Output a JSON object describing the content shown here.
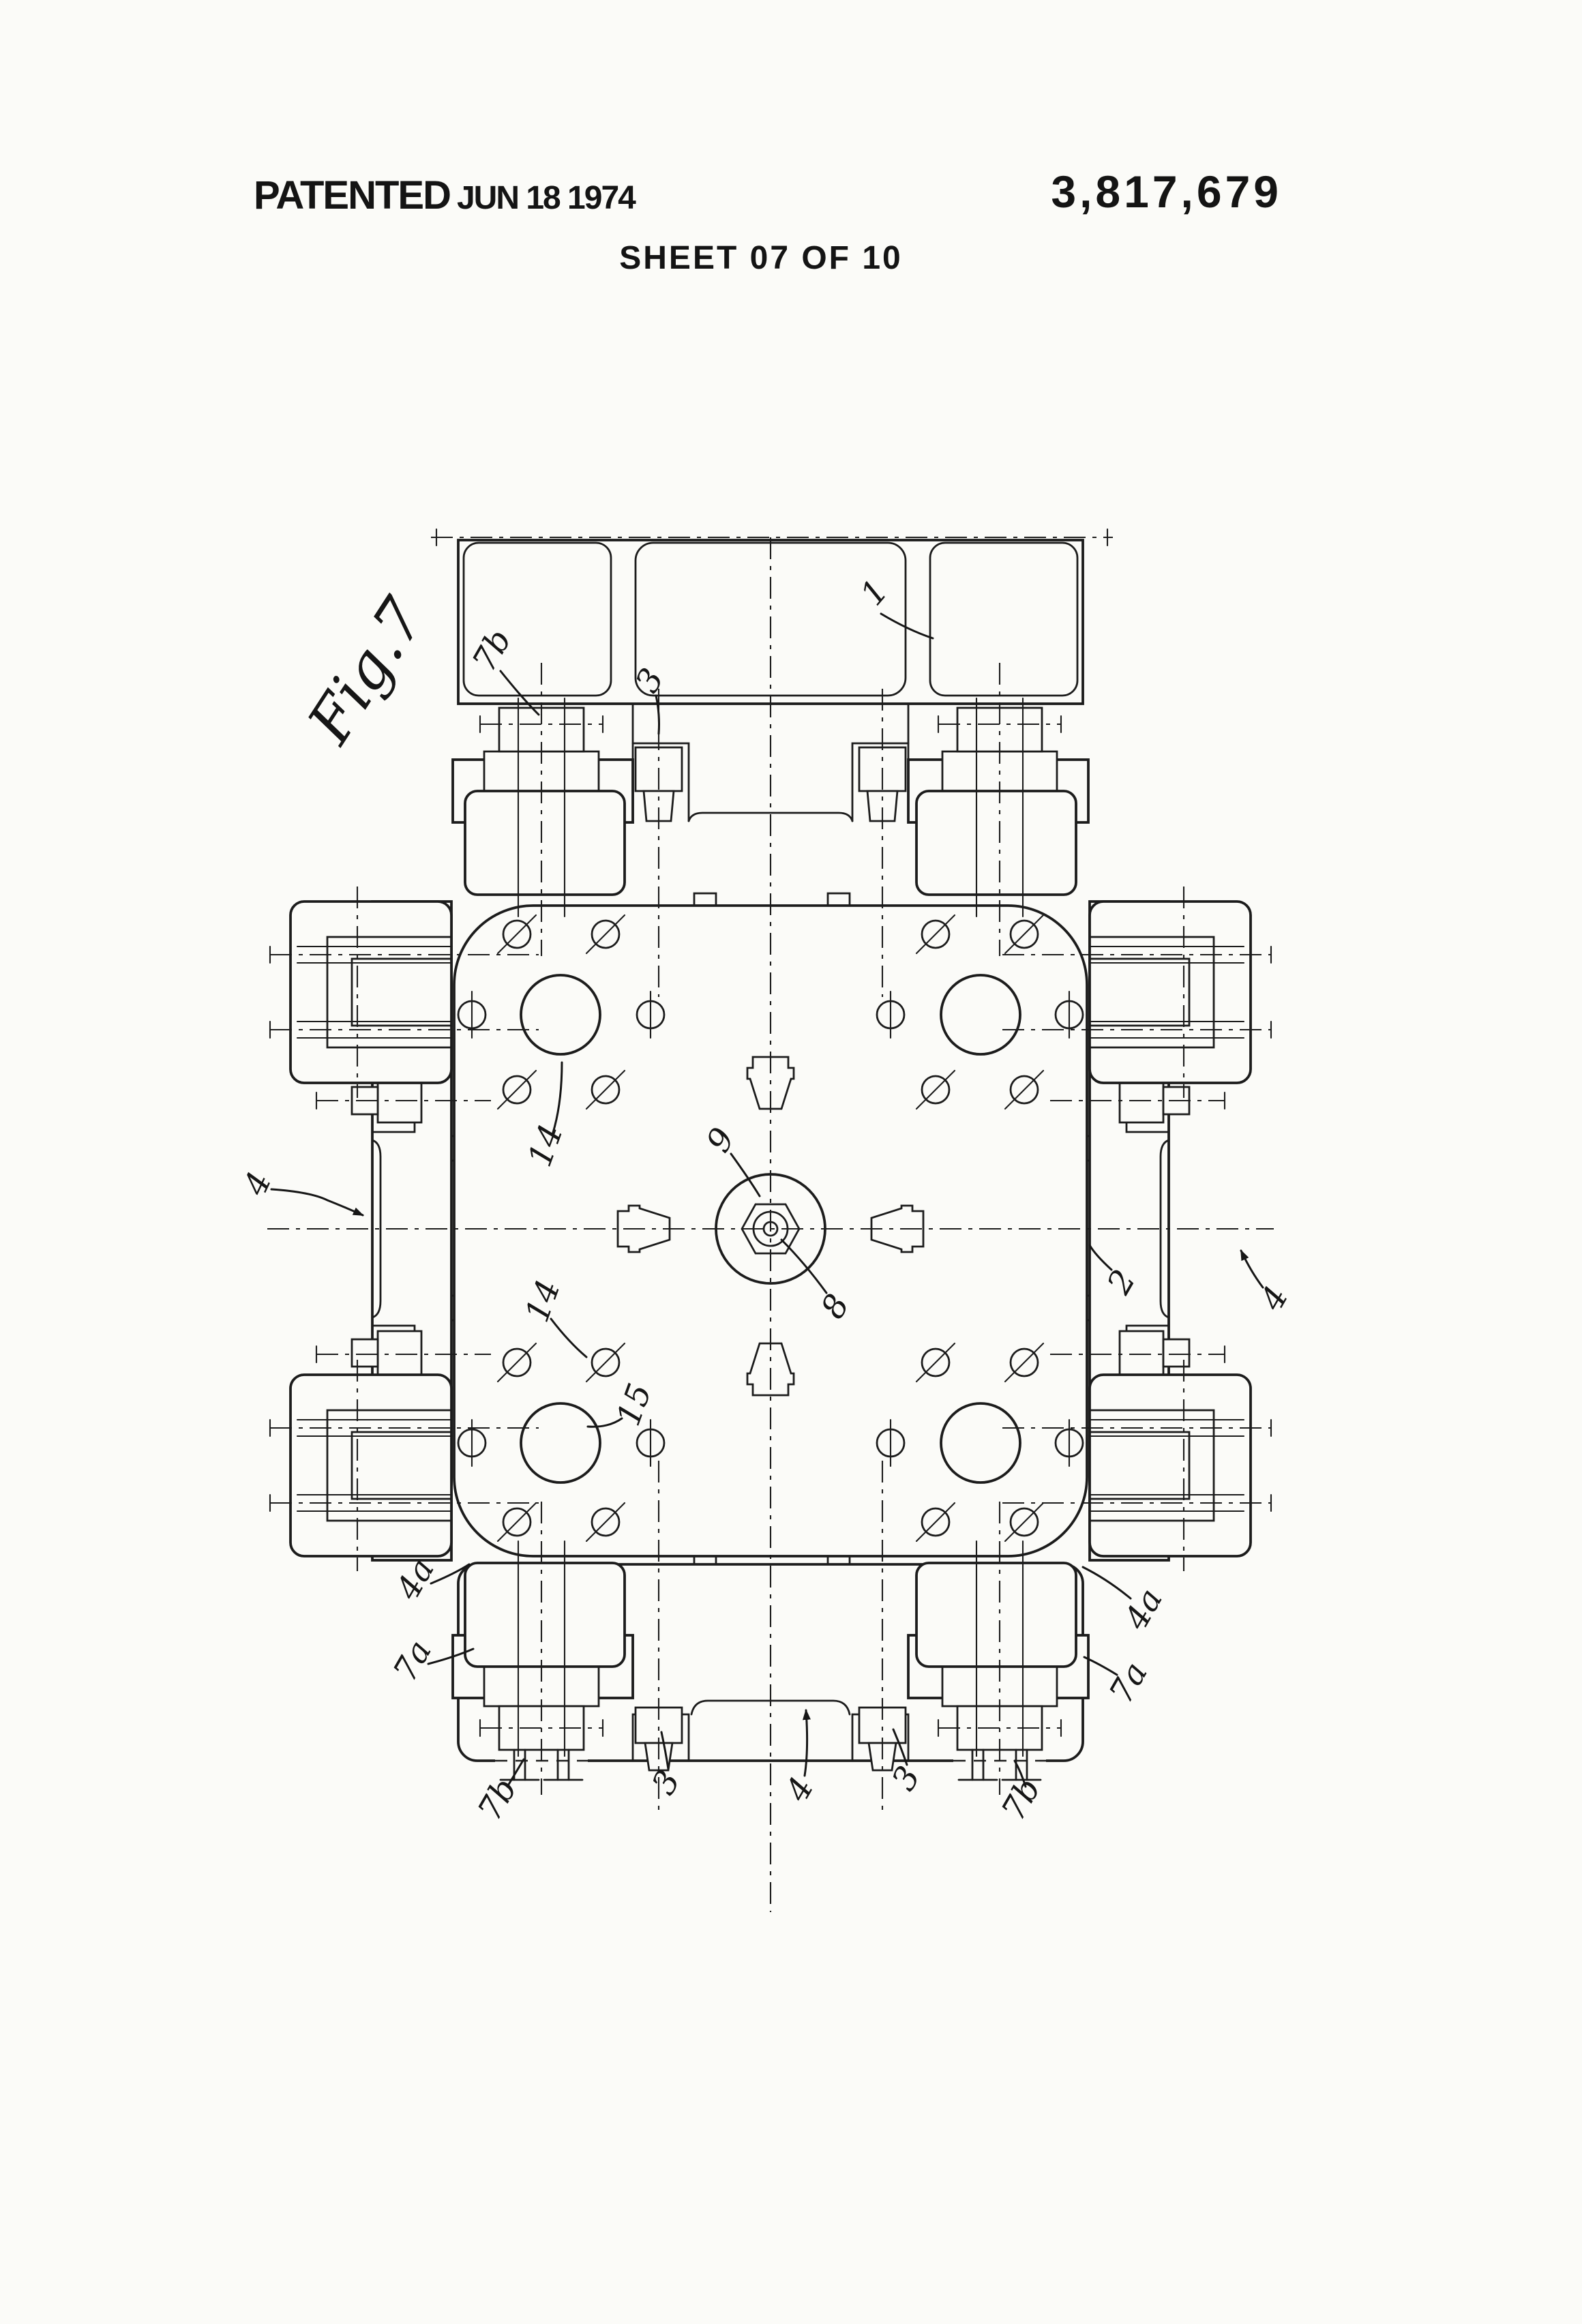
{
  "page": {
    "stamp": "PATENTED",
    "stamp_date": "JUN 18 1974",
    "patent_number": "3,817,679",
    "sheet_info": "SHEET 07 OF 10"
  },
  "figure": {
    "caption": "Fig.7",
    "reference_labels": [
      {
        "text": "1"
      },
      {
        "text": "7b"
      },
      {
        "text": "3"
      },
      {
        "text": "4"
      },
      {
        "text": "14"
      },
      {
        "text": "9"
      },
      {
        "text": "8"
      },
      {
        "text": "14"
      },
      {
        "text": "15"
      },
      {
        "text": "2"
      },
      {
        "text": "4"
      },
      {
        "text": "4a"
      },
      {
        "text": "4a"
      },
      {
        "text": "7a"
      },
      {
        "text": "7a"
      },
      {
        "text": "7b"
      },
      {
        "text": "3"
      },
      {
        "text": "4"
      },
      {
        "text": "3"
      },
      {
        "text": "7b"
      }
    ]
  }
}
